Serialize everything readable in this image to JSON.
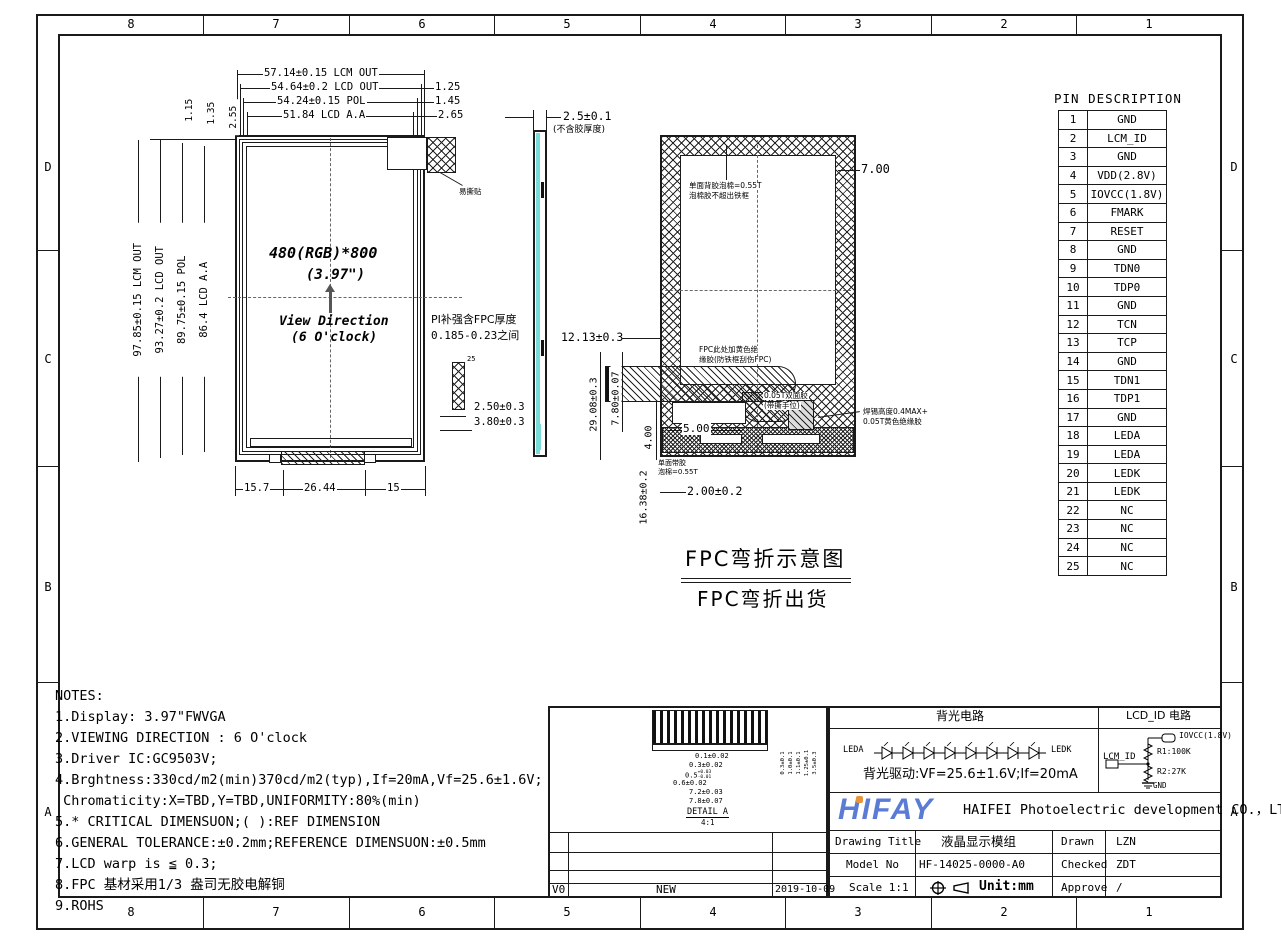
{
  "sheet": {
    "grid_cols": [
      "8",
      "7",
      "6",
      "5",
      "4",
      "3",
      "2",
      "1"
    ],
    "grid_rows": [
      "D",
      "C",
      "B",
      "A"
    ]
  },
  "front": {
    "dim_top": [
      "57.14±0.15 LCM OUT",
      "54.64±0.2 LCD OUT",
      "54.24±0.15 POL",
      "51.84 LCD A.A"
    ],
    "dim_right": [
      "1.25",
      "1.45",
      "2.65"
    ],
    "dim_corner": [
      "1.15",
      "1.35",
      "2.55"
    ],
    "dim_left": [
      "97.85±0.15 LCM OUT",
      "93.27±0.2 LCD OUT",
      "89.75±0.15 POL",
      "86.4 LCD A.A"
    ],
    "dim_bottom": [
      "15.7",
      "26.44",
      "15"
    ],
    "resolution": "480(RGB)*800",
    "size": "(3.97\")",
    "view_dir_1": "View Direction",
    "view_dir_2": "(6 O'clock)",
    "sticker": "易撕贴"
  },
  "side": {
    "thickness": "2.5±0.1",
    "thickness_note": "(不含胶厚度)",
    "pi_note_1": "PI补强含FPC厚度",
    "pi_note_2": "0.185-0.23之间",
    "pin_25": "25",
    "dim_250": "2.50±0.3",
    "dim_380": "3.80±0.3"
  },
  "back": {
    "foam_1": "单面背胶泡棉=0.55T",
    "foam_2": "泡棉胶不超出铁框",
    "dim_700": "7.00",
    "fpc_1": "FPC此处加黄色绝",
    "fpc_2": "缘胶(防铁框刮伤FPC)",
    "tape_1": "0.05T双面胶",
    "tape_2": "(带撕手位)",
    "solder_1": "焊锡高度0.4MAX+",
    "solder_2": "0.05T黄色绝缘胶",
    "foam_b1": "单面带胶",
    "foam_b2": "泡棉=0.55T",
    "dim_1213": "12.13±0.3",
    "dim_2908": "29.08±0.3",
    "dim_780": "7.80±0.07",
    "dim_400": "4.00",
    "dim_500": "5.00",
    "dim_1638": "16.38±0.2",
    "dim_200": "2.00±0.2",
    "title_1": "FPC弯折示意图",
    "title_2": "FPC弯折出货"
  },
  "pin_table": {
    "title": "PIN DESCRIPTION",
    "pins": [
      [
        "1",
        "GND"
      ],
      [
        "2",
        "LCM_ID"
      ],
      [
        "3",
        "GND"
      ],
      [
        "4",
        "VDD(2.8V)"
      ],
      [
        "5",
        "IOVCC(1.8V)"
      ],
      [
        "6",
        "FMARK"
      ],
      [
        "7",
        "RESET"
      ],
      [
        "8",
        "GND"
      ],
      [
        "9",
        "TDN0"
      ],
      [
        "10",
        "TDP0"
      ],
      [
        "11",
        "GND"
      ],
      [
        "12",
        "TCN"
      ],
      [
        "13",
        "TCP"
      ],
      [
        "14",
        "GND"
      ],
      [
        "15",
        "TDN1"
      ],
      [
        "16",
        "TDP1"
      ],
      [
        "17",
        "GND"
      ],
      [
        "18",
        "LEDA"
      ],
      [
        "19",
        "LEDA"
      ],
      [
        "20",
        "LEDK"
      ],
      [
        "21",
        "LEDK"
      ],
      [
        "22",
        "NC"
      ],
      [
        "23",
        "NC"
      ],
      [
        "24",
        "NC"
      ],
      [
        "25",
        "NC"
      ]
    ]
  },
  "notes": {
    "lines": [
      "NOTES:",
      "1.Display: 3.97\"FWVGA",
      "2.VIEWING DIRECTION : 6 O'clock",
      "3.Driver IC:GC9503V;",
      "4.Brghtness:330cd/m2(min)370cd/m2(typ),If=20mA,Vf=25.6±1.6V;",
      " Chromaticity:X=TBD,Y=TBD,UNIFORMITY:80%(min)",
      "5.* CRITICAL DIMENSUON;( ):REF DIMENSION",
      "6.GENERAL TOLERANCE:±0.2mm;REFERENCE DIMENSUON:±0.5mm",
      "7.LCD warp is ≦ 0.3;",
      "8.FPC 基材采用1/3 盎司无胶电解铜",
      "9.ROHS"
    ]
  },
  "detail_a": {
    "dim1": "0.1±0.02",
    "dim2": "0.3±0.02",
    "dim3_base": "0.5",
    "dim3_up": "+0.03",
    "dim3_dn": "-0.01",
    "dim4": "0.6±0.02",
    "dim5": "7.2±0.03",
    "dim6": "7.8±0.07",
    "vdims": [
      "0.3±0.1",
      "1.0±0.1",
      "1.1±0.1",
      "1.25±0.1",
      "3.5±0.3"
    ],
    "label": "DETAIL A",
    "scale": "4:1"
  },
  "revision": {
    "rev": "V0",
    "desc": "NEW",
    "date": "2019-10-09"
  },
  "title_block": {
    "backlight_header": "背光电路",
    "lcdid_header": "LCD_ID 电路",
    "leda": "LEDA",
    "ledk": "LEDK",
    "drive": "背光驱动:VF=25.6±1.6V;If=20mA",
    "iovcc": "IOVCC(1.8V)",
    "r1": "R1:100K",
    "lcm_id": "LCM_ID",
    "r2": "R2:27K",
    "gnd": "GND",
    "logo": "HIFAY",
    "company": "HAIFEI Photoelectric development CO.，LTD",
    "r1c1": "Drawing Title",
    "r1c2": "液晶显示模组",
    "r1c3": "Drawn",
    "r1c4": "LZN",
    "r2c1": "Model No",
    "r2c2": "HF-14025-0000-A0",
    "r2c3": "Checked",
    "r2c4": "ZDT",
    "r3c1": "Scale 1:1",
    "r3c2": "Unit:mm",
    "r3c3": "Approve",
    "r3c4": "/"
  },
  "colors": {
    "panel_cyan": "#79dcd8",
    "logo_blue": "#5b7bd5",
    "logo_orange": "#e8953a"
  }
}
